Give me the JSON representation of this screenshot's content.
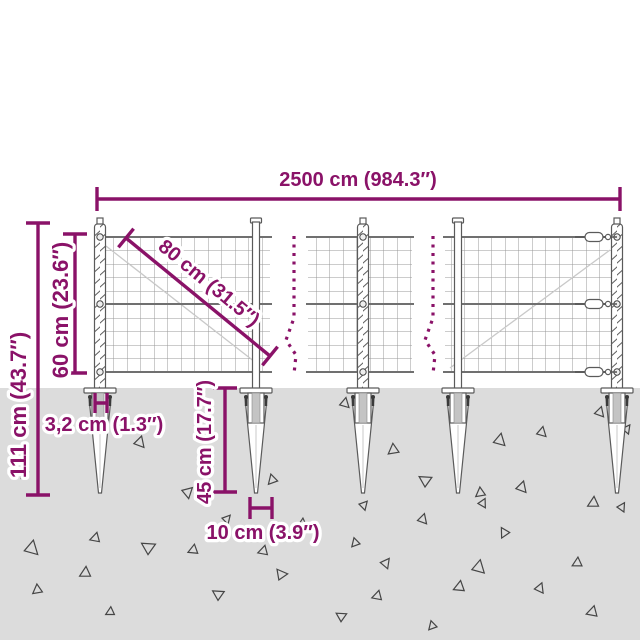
{
  "diagram": {
    "title": "wire-mesh-fence-with-spike-anchors-dimension-diagram",
    "colors": {
      "accent": "#8a1268",
      "ground": "#dcdcdc"
    },
    "dimensions": {
      "total_width": "2500 cm (984.3″)",
      "total_height": "111 cm (43.7″)",
      "mesh_height": "60 cm (23.6″)",
      "mesh_diagonal": "80 cm (31.5″)",
      "post_width": "3,2 cm (1.3″)",
      "spike_length": "45 cm (17.7″)",
      "spike_width": "10 cm (3.9″)"
    }
  }
}
